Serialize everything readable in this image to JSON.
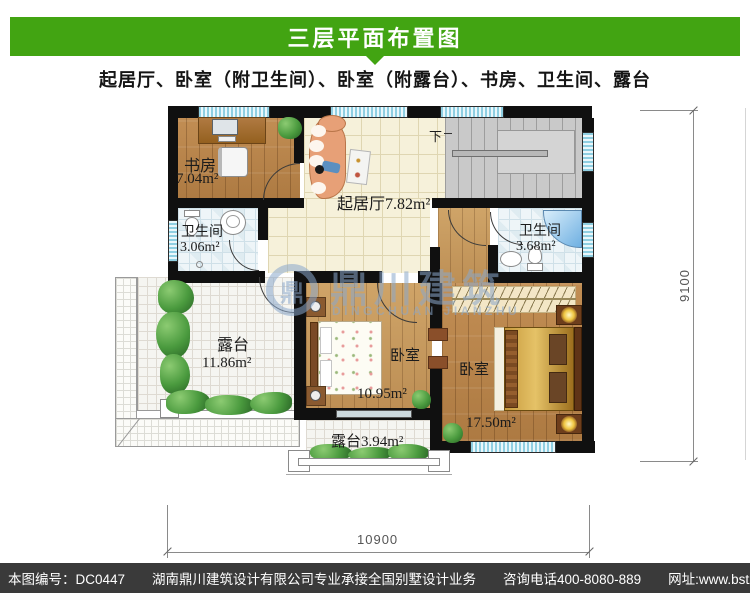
{
  "header": {
    "title": "三层平面布置图",
    "subtitle": "起居厅、卧室（附卫生间）、卧室（附露台）、书房、卫生间、露台",
    "bar_color": "#42a412"
  },
  "plan": {
    "rooms": {
      "study": {
        "name": "书房",
        "area": "7.04m²"
      },
      "living": {
        "label": "起居厅7.82m²"
      },
      "bath_left": {
        "name": "卫生间",
        "area": "3.06m²"
      },
      "bath_right": {
        "name": "卫生间",
        "area": "3.68m²"
      },
      "terrace_large": {
        "name": "露台",
        "area": "11.86m²"
      },
      "bedroom_center": {
        "name": "卧室",
        "area": "10.95m²"
      },
      "bedroom_right": {
        "name": "卧室",
        "area": "17.50m²"
      },
      "terrace_small": {
        "label": "露台3.94m²"
      }
    },
    "stairs": {
      "down_label": "下"
    },
    "dimensions": {
      "bottom": "10900",
      "right": "9100"
    },
    "watermark": {
      "logo_glyph": "鼎",
      "cn": "鼎川建筑",
      "en": "DINGCHUAN JIANZHU"
    }
  },
  "footer": {
    "bg": "#3a3a3a",
    "plan_no": "本图编号：DC0447",
    "company": "湖南鼎川建筑设计有限公司专业承接全国别墅设计业务",
    "phone": "咨询电话400-8080-889",
    "website": "网址:www.bstzcs.com"
  }
}
